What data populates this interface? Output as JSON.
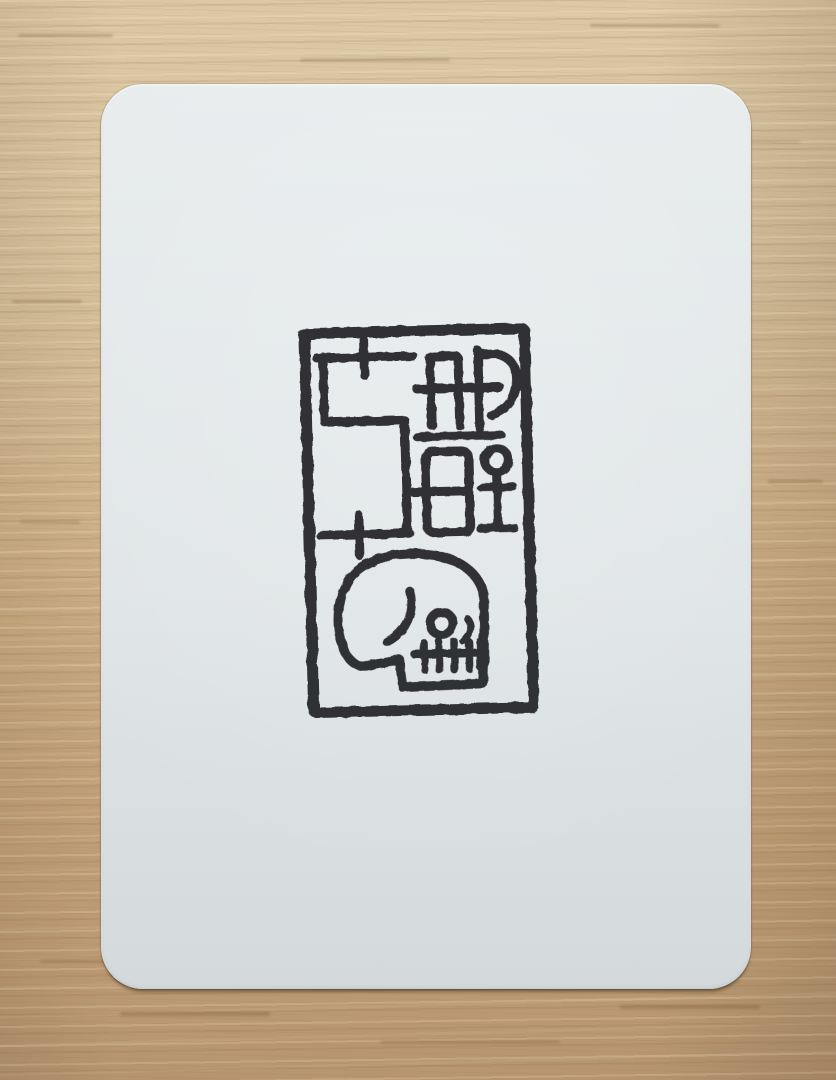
{
  "scene": {
    "type": "photograph",
    "description": "A white card with rounded corners lying on a light wooden table, hand-stamped in black ink with a rectangular seal design containing abstract glyphs and a side-profile skull"
  },
  "colors": {
    "ink": "#26262a",
    "card_top": "#e8eced",
    "card_bottom": "#d4dadc",
    "wood_light": "#dcc8a5",
    "wood_dark": "#b79571"
  },
  "surface": {
    "label": "light wood table surface with horizontal grain"
  },
  "card": {
    "label": "blank white rounded-corner card",
    "corner_radius_px": 42
  },
  "stamp": {
    "label": "black ink seal stamp",
    "motifs": [
      {
        "id": "seal-border",
        "label": "rectangular seal border"
      },
      {
        "id": "five-glyph",
        "label": "angular 5-shaped glyph with two cross marks"
      },
      {
        "id": "ad-monogram",
        "label": "AD monogram with horizontal crossbar"
      },
      {
        "id": "underline",
        "label": "horizontal rule under monogram"
      },
      {
        "id": "window-glyph",
        "label": "two-pane window glyph with side tick"
      },
      {
        "id": "key-glyph",
        "label": "circle above I-beam key glyph"
      },
      {
        "id": "skull",
        "label": "side-profile skull with round eye socket, brow curve, nose notch and five teeth"
      }
    ]
  }
}
